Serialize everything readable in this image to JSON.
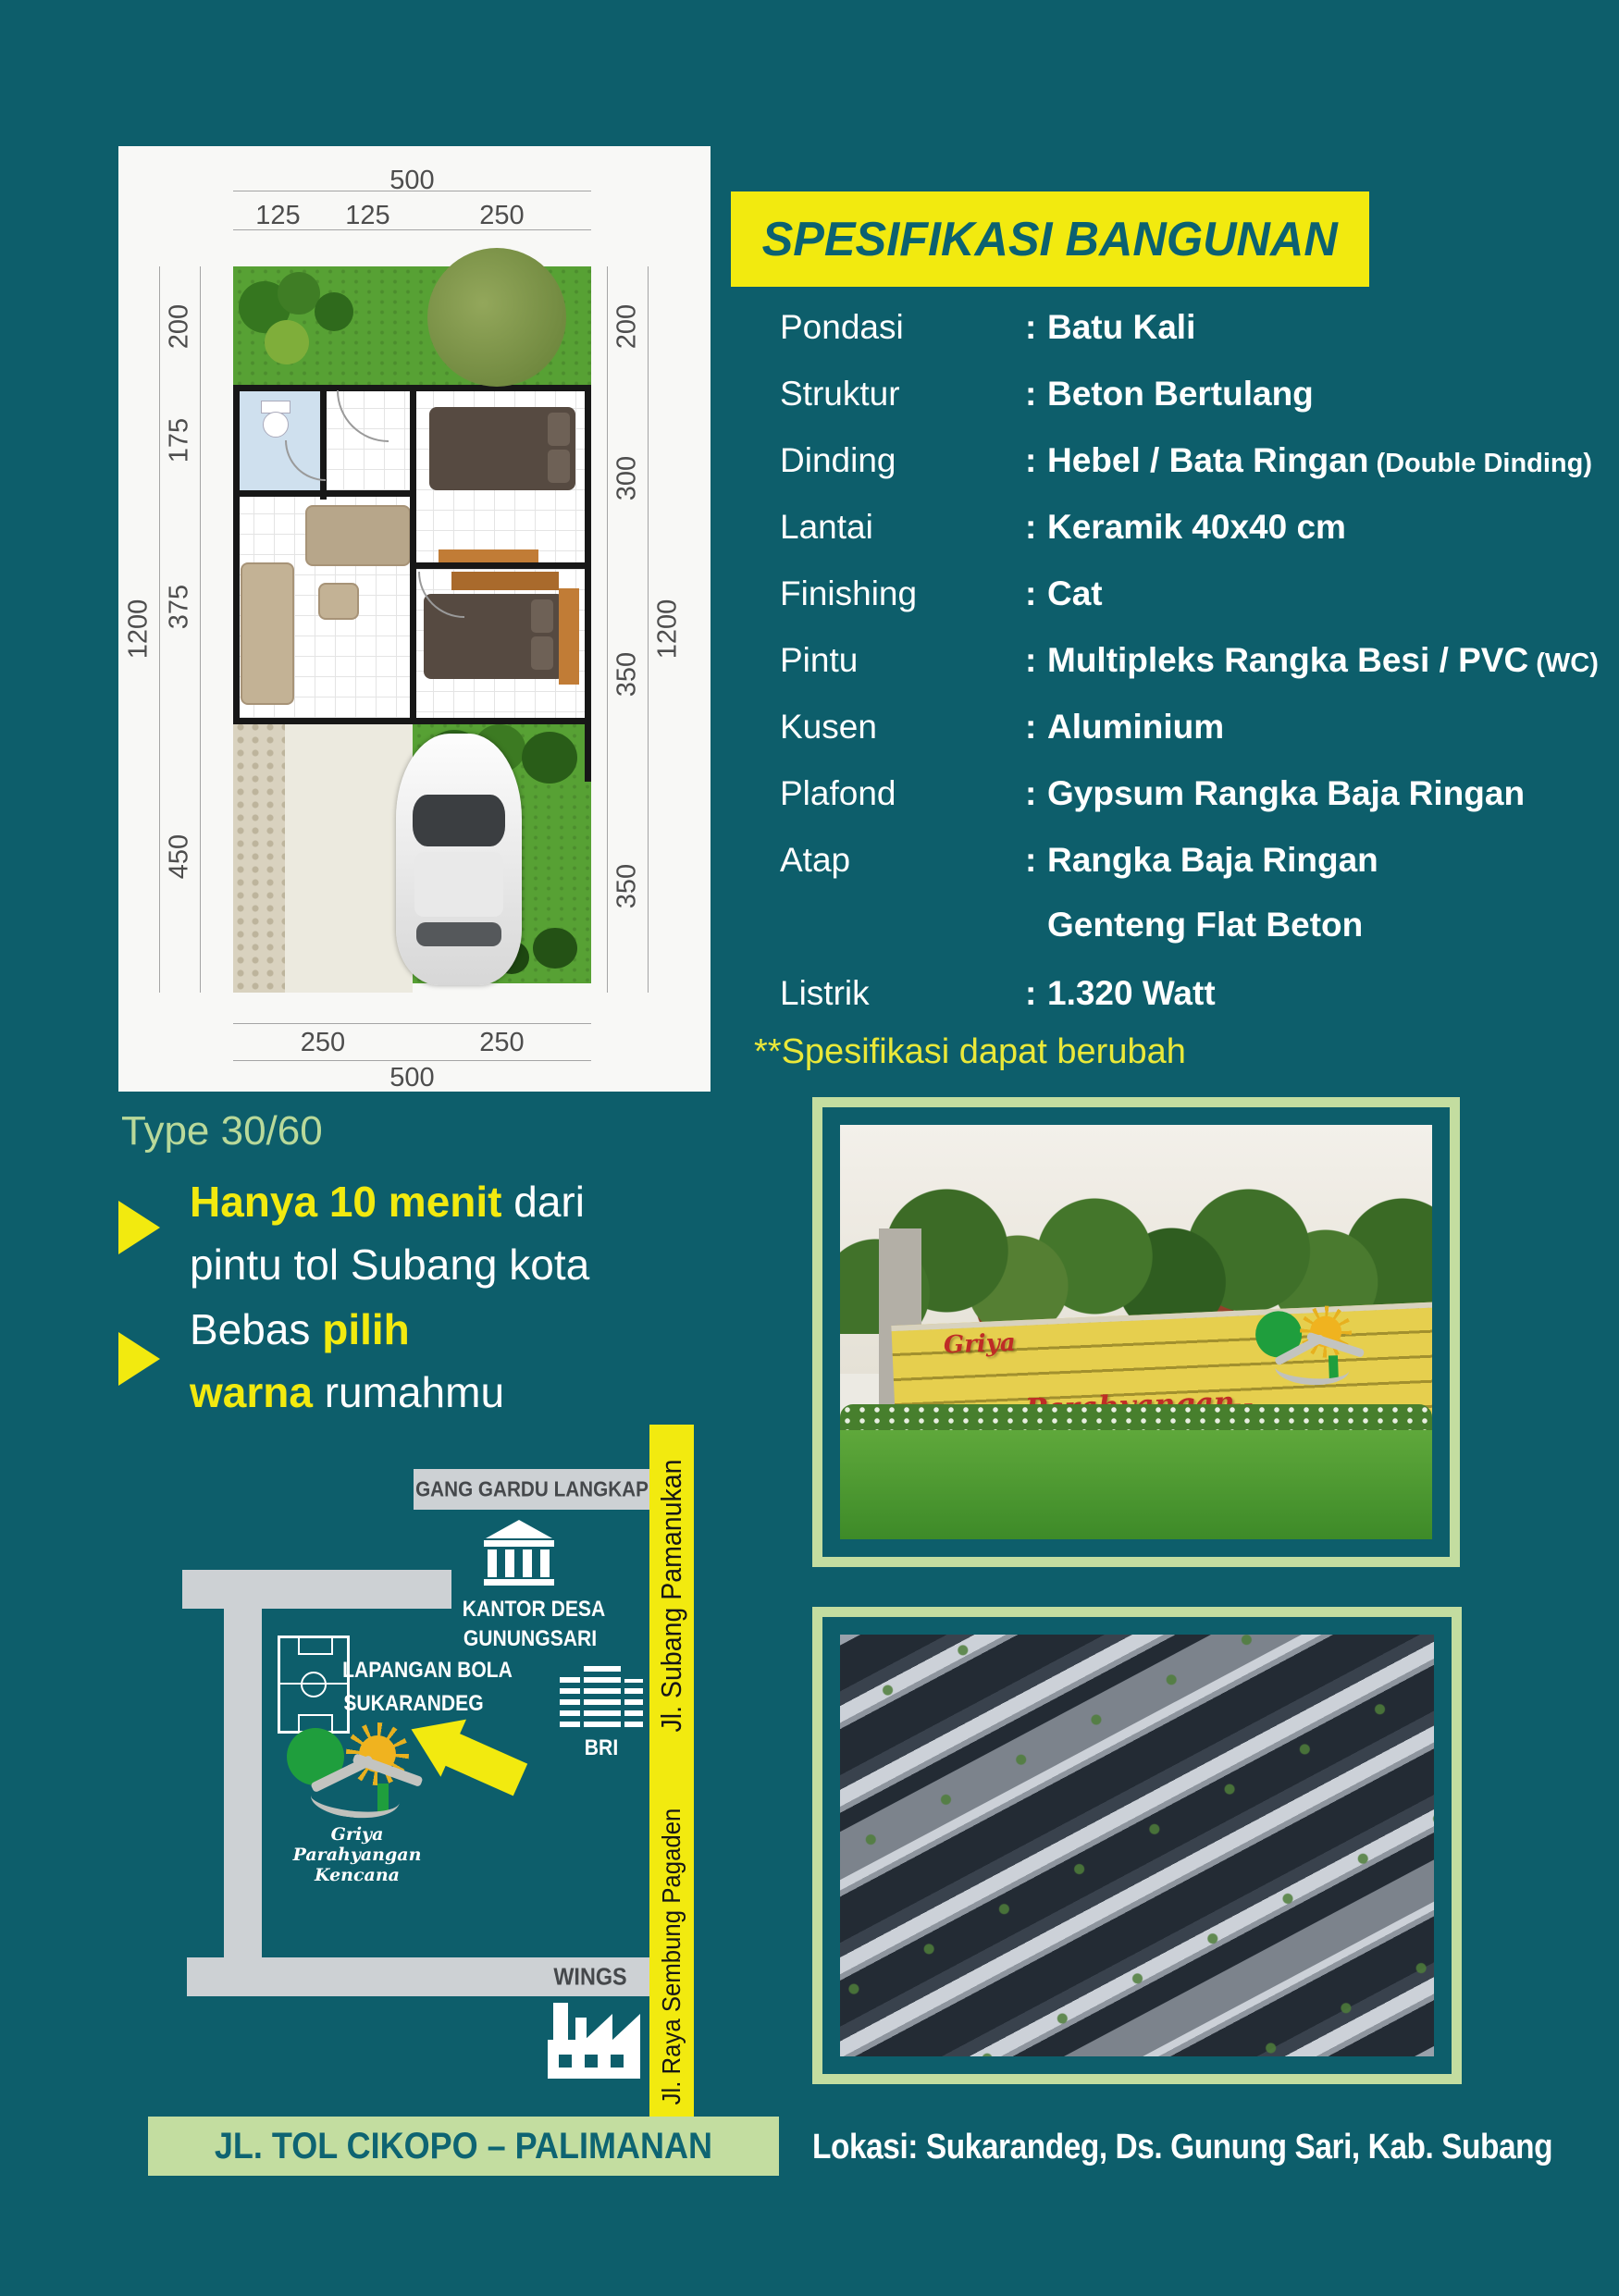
{
  "colors": {
    "teal_bg": "#0d5e6b",
    "yellow": "#f2ea0f",
    "light_green": "#c3dda0",
    "title_teal": "#0c6170",
    "road_gray": "#cdd1d4",
    "sign_red": "#bf2c26"
  },
  "plan": {
    "type_label": "Type 30/60",
    "dims": {
      "top_total": "500",
      "top_segs": [
        "125",
        "125",
        "250"
      ],
      "bottom_segs": [
        "250",
        "250"
      ],
      "bottom_total": "500",
      "left_total": "1200",
      "left_segs": [
        "200",
        "175",
        "375",
        "450"
      ],
      "right_total": "1200",
      "right_segs": [
        "200",
        "300",
        "350",
        "350"
      ]
    }
  },
  "spec": {
    "title": "SPESIFIKASI BANGUNAN",
    "colon": ":",
    "rows": [
      {
        "label": "Pondasi",
        "value": "Batu Kali"
      },
      {
        "label": "Struktur",
        "value": "Beton Bertulang"
      },
      {
        "label": "Dinding",
        "value": "Hebel / Bata Ringan",
        "note": "(Double Dinding)"
      },
      {
        "label": "Lantai",
        "value": "Keramik 40x40 cm"
      },
      {
        "label": "Finishing",
        "value": "Cat"
      },
      {
        "label": "Pintu",
        "value": "Multipleks Rangka Besi / PVC",
        "note": "(WC)"
      },
      {
        "label": "Kusen",
        "value": "Aluminium"
      },
      {
        "label": "Plafond",
        "value": "Gypsum Rangka Baja Ringan"
      },
      {
        "label": "Atap",
        "value": "Rangka Baja Ringan",
        "value2": "Genteng Flat Beton"
      },
      {
        "label": "Listrik",
        "value": "1.320 Watt"
      }
    ],
    "disclaimer": "**Spesifikasi dapat berubah"
  },
  "highlights": {
    "b1_yellow": "Hanya 10 menit",
    "b1_white": " dari",
    "b1_line2": "pintu tol Subang kota",
    "b2_white1": "Bebas ",
    "b2_yellow1": "pilih",
    "b2_yellow2": "warna",
    "b2_white2": " rumahmu"
  },
  "map": {
    "road_top": "GANG GARDU LANGKAP",
    "road_vertical_top": "Jl. Subang Pamanukan",
    "road_vertical_bottom": "Jl. Raya Sembung Pagaden",
    "poi_office_line1": "KANTOR DESA",
    "poi_office_line2": "GUNUNGSARI",
    "poi_field_line1": "LAPANGAN BOLA",
    "poi_field_line2": "SUKARANDEG",
    "poi_bank": "BRI",
    "poi_factory": "WINGS",
    "logo_text": "Griya Parahyangan Kencana",
    "toll_banner": "JL. TOL CIKOPO – PALIMANAN"
  },
  "photo_gate": {
    "sign_word1": "Griya",
    "sign_word2": "Parahyangan",
    "sign_word3": "Kencana"
  },
  "footer": {
    "location": "Lokasi: Sukarandeg, Ds. Gunung Sari, Kab. Subang"
  }
}
